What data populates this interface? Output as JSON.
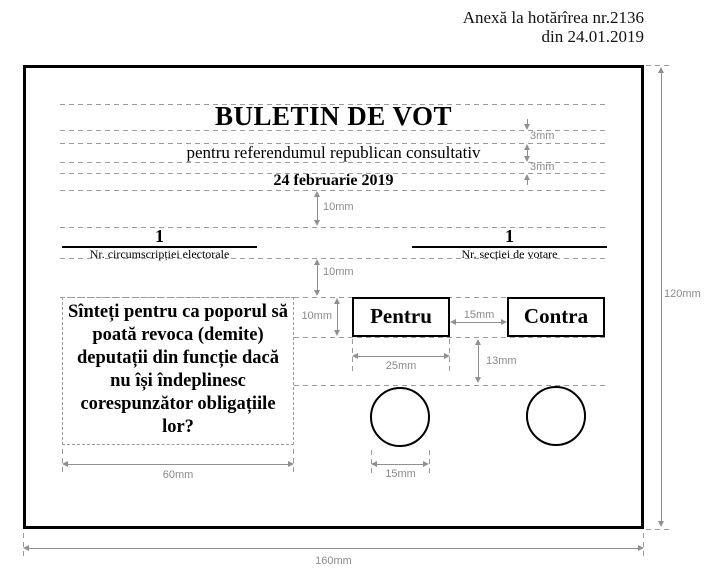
{
  "annotation": {
    "line1": "Anexă la hotărîrea nr.2136",
    "line2": "din 24.01.2019"
  },
  "ballot": {
    "title": "BULETIN DE VOT",
    "subtitle": "pentru referendumul republican consultativ",
    "date": "24 februarie 2019",
    "constituency_number": "1",
    "constituency_label": "Nr. circumscripției electorale",
    "polling_station_number": "1",
    "polling_station_label": "Nr. secției de votare",
    "question_lines": [
      "Sînteți pentru ca poporul să",
      "poată revoca (demite)",
      "deputații din funcție dacă",
      "nu își îndeplinesc",
      "corespunzător obligațiile",
      "lor?"
    ],
    "option_for": "Pentru",
    "option_against": "Contra"
  },
  "dimensions": {
    "title_gap_top": "3mm",
    "title_gap_bottom": "3mm",
    "below_date": "10mm",
    "below_numbers": "10mm",
    "option_height": "10mm",
    "between_options": "15mm",
    "option_width": "25mm",
    "option_to_circle": "13mm",
    "circle_width": "15mm",
    "question_width": "60mm",
    "ballot_height": "120mm",
    "ballot_width": "160mm"
  },
  "colors": {
    "ink": "#000000",
    "dimension": "#8c8c8c",
    "guide": "#9b9b9b",
    "background": "#ffffff"
  }
}
